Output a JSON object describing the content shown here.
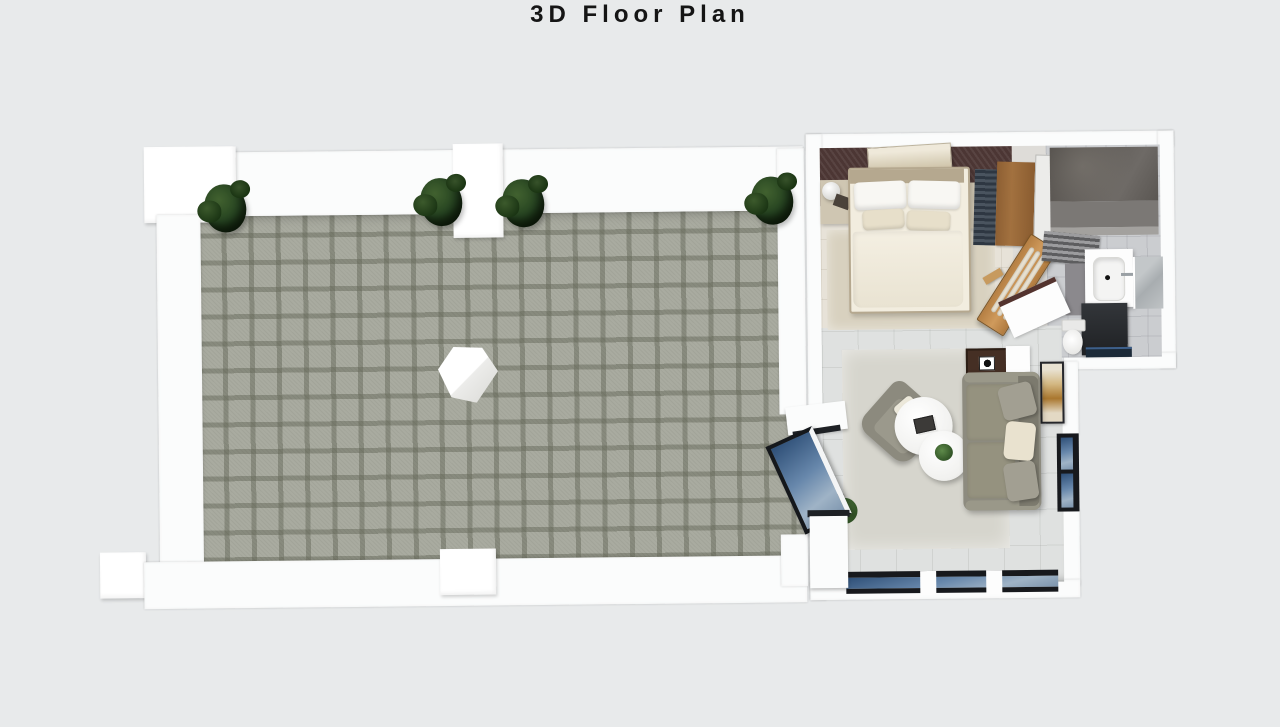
{
  "page": {
    "title": "3D Floor Plan"
  },
  "colors": {
    "pageBg": "#e8eaeb",
    "titleColor": "#151515",
    "wall": "#fbfcfc",
    "terraceTile": "#a9aba0",
    "bedroomFloor": "#e7e2d8",
    "bedRug": "#d8d1bf",
    "accentWall": "#4c3634",
    "linen": "#f2eddf",
    "pillowWhite": "#f8f7f3",
    "pillowCream": "#e7dfca",
    "bedFrame": "#b5a88f",
    "nightstand": "#cfc6b2",
    "hallFloor": "#dedcd8",
    "bathFloor": "#cbcdd0",
    "showerBand": "#7b7875",
    "cabinetGray": "#8b898d",
    "livingFloor": "#dfe1e0",
    "livingRug": "#d6d5cd",
    "sofa": "#8d8b7f",
    "sofaBack": "#7c7a6e",
    "armchair": "#8c8a7e",
    "sideTable": "#452f24",
    "frameDark": "#17191d",
    "maroonEdge": "#53332e"
  },
  "scene": {
    "view": "top-down-3d-render",
    "rooms": [
      "terrace",
      "bedroom",
      "bathroom",
      "living-room"
    ],
    "terrace_items": [
      "tiled-floor",
      "corner-plant",
      "pillar-plants",
      "freestanding-column"
    ],
    "bedroom_items": [
      "double-bed",
      "white-pillows",
      "cream-pillows",
      "nightstand-lamps",
      "wall-art",
      "accent-wall",
      "area-rug",
      "wardrobe",
      "open-wood-door"
    ],
    "bathroom_items": [
      "walk-in-shower",
      "vanity-sink",
      "mirror",
      "dark-cabinet",
      "toilet",
      "striped-mat"
    ],
    "living_items": [
      "gray-sofa",
      "throw-pillows",
      "armchair",
      "nesting-coffee-tables",
      "dark-side-table",
      "white-console",
      "wall-art",
      "glass-door",
      "window-band",
      "floor-plants"
    ]
  }
}
